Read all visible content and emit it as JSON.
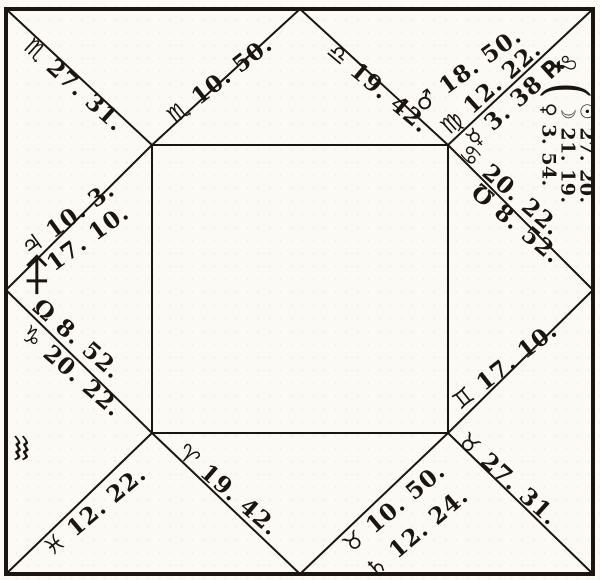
{
  "figure": {
    "kind": "square horoscope (figure of heaven), engraved style",
    "ink_color": "#1a1511",
    "paper_color": "#fbfaf5"
  },
  "labels": {
    "cusp12": "♏ 27. 31.",
    "cusp11": "♏ 10. 50.",
    "cusp10": "♎ 19. 42.",
    "mars": "♂ 18. 50.",
    "cusp9": "♍ 12. 22.",
    "mercury": "☿ 3. 38 ℞",
    "leo_sign": "♌",
    "brace": "(",
    "sun": "☉ 27. 20.",
    "moon": "☽ 21. 19.",
    "venus": "♀ 3. 54.",
    "cusp8": "♋ 20. 22.",
    "south_node": "℧ 8. 52.",
    "cusp7": "♊ 17. 10.",
    "cusp6": "♉ 27. 31.",
    "saturn": "♄ 12. 24.",
    "cusp5": "♉ 10. 50.",
    "cusp4": "♈ 19. 42.",
    "cusp3": "♓ 12. 22.",
    "cusp2": "♑ 20. 22.",
    "north_node": "Ω 8. 52.",
    "jupiter": "♃ 10. 3.",
    "ascendant_degrees": "17. 10.",
    "sagittarius_arrow": "♐",
    "aquarius_intercepted": "♒"
  }
}
